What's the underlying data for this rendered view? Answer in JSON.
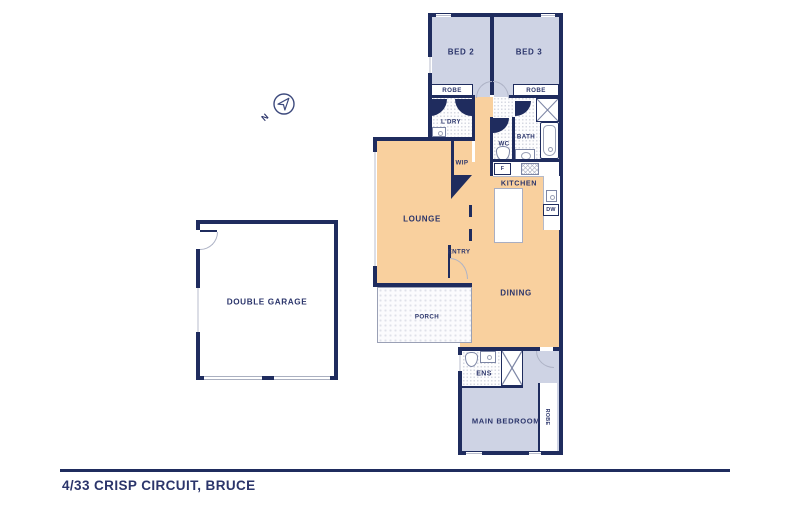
{
  "title": {
    "address": "4/33 CRISP CIRCUIT, BRUCE"
  },
  "compass": {
    "label": "N"
  },
  "rooms": {
    "bed2": "BED 2",
    "bed3": "BED 3",
    "laundry": "L'DRY",
    "wc": "WC",
    "bath": "BATH",
    "wip": "WIP",
    "kitchen": "KITCHEN",
    "lounge": "LOUNGE",
    "entry": "ENTRY",
    "dining": "DINING",
    "porch": "PORCH",
    "ensuite": "ENS",
    "main_bedroom": "MAIN BEDROOM",
    "double_garage": "DOUBLE GARAGE"
  },
  "fixtures": {
    "robe_bed2": "ROBE",
    "robe_bed3": "ROBE",
    "robe_main": "ROBE",
    "fridge": "F",
    "dishwasher": "DW"
  },
  "colors": {
    "wall_navy": "#1f2c5e",
    "living_floor": "#f9d09e",
    "bedroom_floor": "#ced3e4",
    "label_text": "#2b356b"
  }
}
